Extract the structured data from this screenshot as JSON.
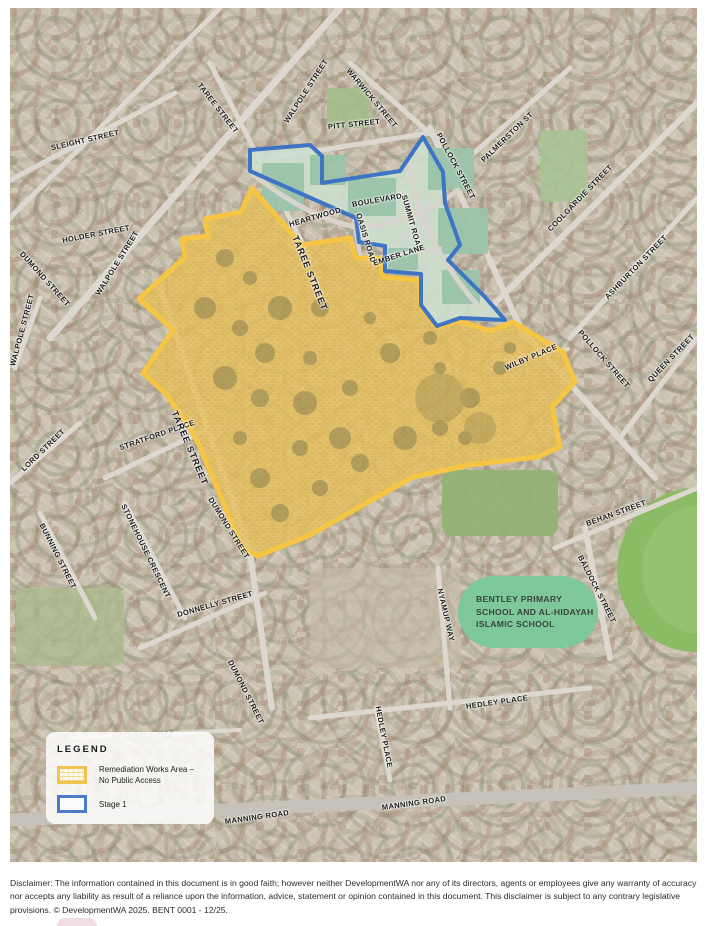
{
  "colors": {
    "remediation_fill": "#E8C15E",
    "remediation_border": "#F6C544",
    "stage1_border": "#3D74C4",
    "school_label_bg": "#7CC99A",
    "street_label_text": "#1A1A1A"
  },
  "map": {
    "street_labels": [
      {
        "text": "SLEIGHT STREET",
        "x": 75,
        "y": 132,
        "rot": -13
      },
      {
        "text": "TAREE STREET",
        "x": 208,
        "y": 100,
        "rot": 52
      },
      {
        "text": "WALPOLE STREET",
        "x": 296,
        "y": 83,
        "rot": -57
      },
      {
        "text": "WARWICK STREET",
        "x": 362,
        "y": 90,
        "rot": 50
      },
      {
        "text": "PITT STREET",
        "x": 344,
        "y": 116,
        "rot": -6
      },
      {
        "text": "POLLOCK STREET",
        "x": 446,
        "y": 158,
        "rot": 62
      },
      {
        "text": "PALMERSTON ST",
        "x": 497,
        "y": 129,
        "rot": -44
      },
      {
        "text": "COOLGARDIE STREET",
        "x": 570,
        "y": 190,
        "rot": -46
      },
      {
        "text": "ASHBURTON STREET",
        "x": 626,
        "y": 259,
        "rot": -46
      },
      {
        "text": "HOLDER STREET",
        "x": 86,
        "y": 226,
        "rot": -11
      },
      {
        "text": "WALPOLE STREET",
        "x": 107,
        "y": 255,
        "rot": -58
      },
      {
        "text": "DUMOND STREET",
        "x": 35,
        "y": 271,
        "rot": 48
      },
      {
        "text": "WALPOLE STREET",
        "x": 12,
        "y": 322,
        "rot": -75
      },
      {
        "text": "LORD STREET",
        "x": 33,
        "y": 442,
        "rot": -44
      },
      {
        "text": "STRATFORD PLACE",
        "x": 147,
        "y": 427,
        "rot": -19
      },
      {
        "text": "BUNNING STREET",
        "x": 48,
        "y": 548,
        "rot": 63
      },
      {
        "text": "STONEHOUSE CRESCENT",
        "x": 136,
        "y": 543,
        "rot": 64
      },
      {
        "text": "DONNELLY STREET",
        "x": 205,
        "y": 596,
        "rot": -16
      },
      {
        "text": "DUMOND STREET",
        "x": 219,
        "y": 520,
        "rot": 58
      },
      {
        "text": "DUMOND STREET",
        "x": 236,
        "y": 684,
        "rot": 63
      },
      {
        "text": "TAREE STREET",
        "x": 300,
        "y": 265,
        "rot": 68,
        "size": "big"
      },
      {
        "text": "TAREE STREET",
        "x": 180,
        "y": 440,
        "rot": 67,
        "size": "big"
      },
      {
        "text": "HEARTWOOD",
        "x": 305,
        "y": 209,
        "rot": -16
      },
      {
        "text": "BOULEVARD",
        "x": 367,
        "y": 192,
        "rot": -10
      },
      {
        "text": "OASIS ROAD",
        "x": 356,
        "y": 230,
        "rot": 73
      },
      {
        "text": "SUMMIT ROAD",
        "x": 402,
        "y": 215,
        "rot": 74
      },
      {
        "text": "EMBER LANE",
        "x": 389,
        "y": 247,
        "rot": -18
      },
      {
        "text": "WILBY PLACE",
        "x": 521,
        "y": 349,
        "rot": -23
      },
      {
        "text": "POLLOCK STREET",
        "x": 594,
        "y": 351,
        "rot": 49
      },
      {
        "text": "QUEEN STREET",
        "x": 661,
        "y": 350,
        "rot": -46
      },
      {
        "text": "BEHAN STREET",
        "x": 606,
        "y": 505,
        "rot": -20
      },
      {
        "text": "BALDOCK STREET",
        "x": 587,
        "y": 581,
        "rot": 63
      },
      {
        "text": "NYAMUP WAY",
        "x": 436,
        "y": 607,
        "rot": 77
      },
      {
        "text": "HEDLEY PLACE",
        "x": 487,
        "y": 694,
        "rot": -8
      },
      {
        "text": "HEDLEY PLACE",
        "x": 374,
        "y": 729,
        "rot": 79
      },
      {
        "text": "MANNING ROAD",
        "x": 247,
        "y": 809,
        "rot": -8
      },
      {
        "text": "MANNING ROAD",
        "x": 404,
        "y": 795,
        "rot": -8
      },
      {
        "text": "DEVERELL WAY",
        "x": 133,
        "y": 727,
        "rot": -6,
        "faint": true
      }
    ]
  },
  "school": {
    "lines": [
      "BENTLEY PRIMARY",
      "SCHOOL AND AL-HIDAYAH",
      "ISLAMIC SCHOOL"
    ]
  },
  "legend": {
    "title": "LEGEND",
    "items": [
      {
        "swatch": "remediation",
        "lines": [
          "Remediation Works Area –",
          "No Public Access"
        ]
      },
      {
        "swatch": "stage1",
        "lines": [
          "Stage 1"
        ]
      }
    ]
  },
  "disclaimer": {
    "text": "Disclaimer: The information contained in this document is in good faith; however neither DevelopmentWA nor any of its directors, agents or employees give any warranty of accuracy nor accepts any liability as result of a reliance upon the information, advice, statement or opinion contained in this document. This disclaimer is subject to any contrary legislative provisions. © DevelopmentWA 2025. BENT 0001 - 12/25."
  }
}
